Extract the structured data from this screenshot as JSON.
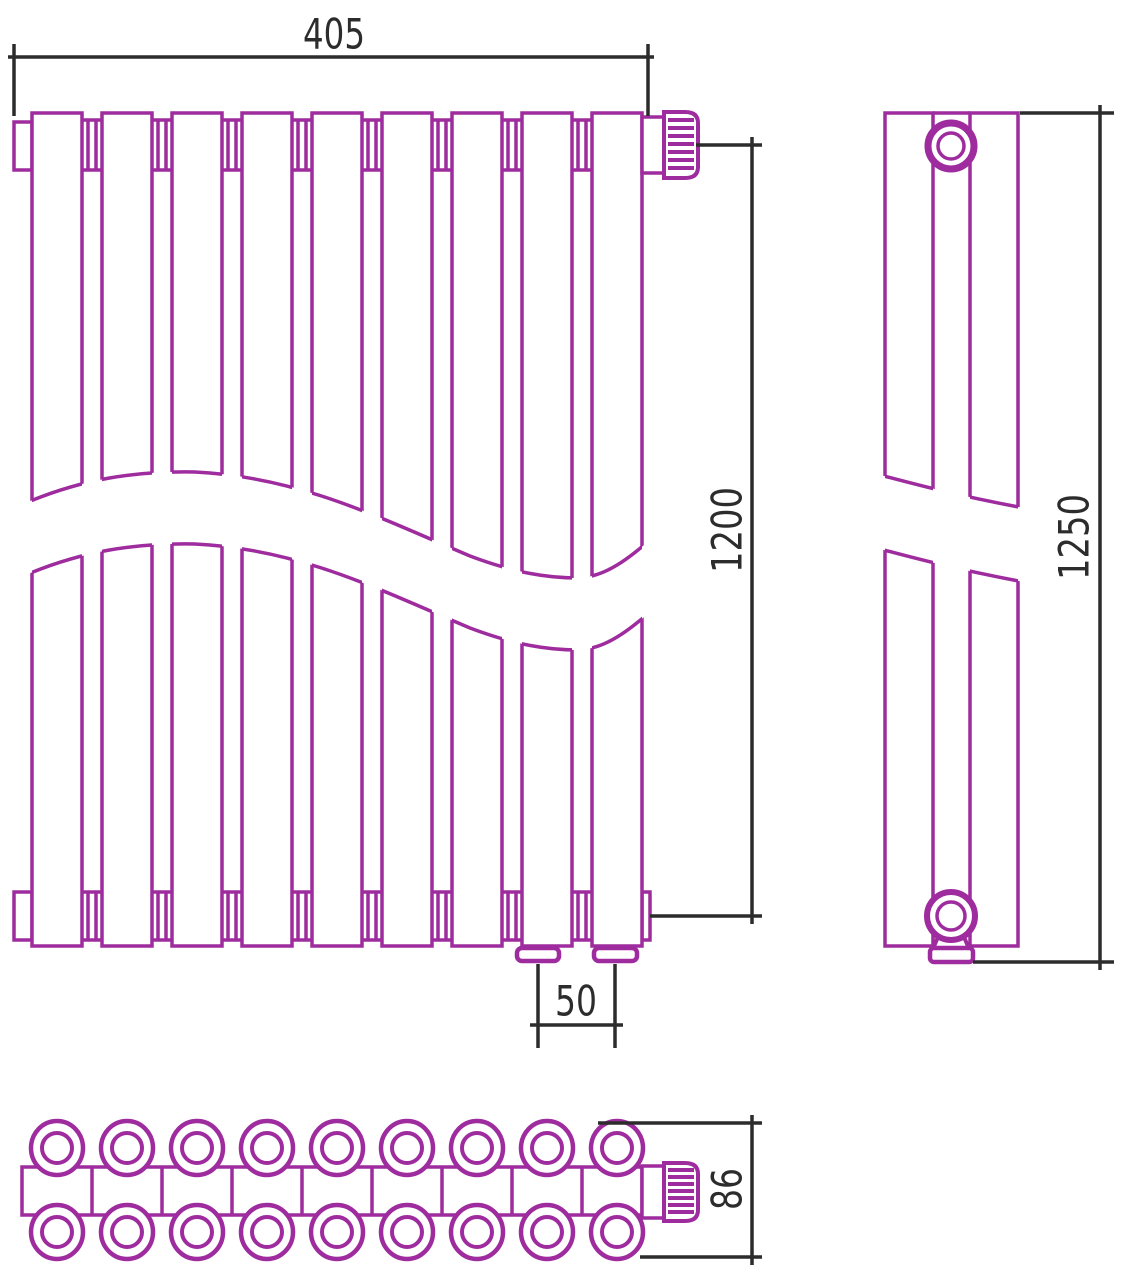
{
  "title": "Vertical radiator technical drawing, three views",
  "colors": {
    "outline": "#9E2C9E",
    "dimension_lines": "#2C2C2C",
    "background": "#FFFFFF"
  },
  "views": {
    "front": {
      "label": "front-view",
      "section_count": 9
    },
    "side": {
      "label": "side-view"
    },
    "top": {
      "label": "top-view",
      "tube_rows": 2,
      "tubes_per_row": 9
    }
  },
  "dimensions": {
    "width": "405",
    "connection_height": "1200",
    "connection_spacing": "50",
    "overall_height": "1250",
    "depth": "86"
  }
}
